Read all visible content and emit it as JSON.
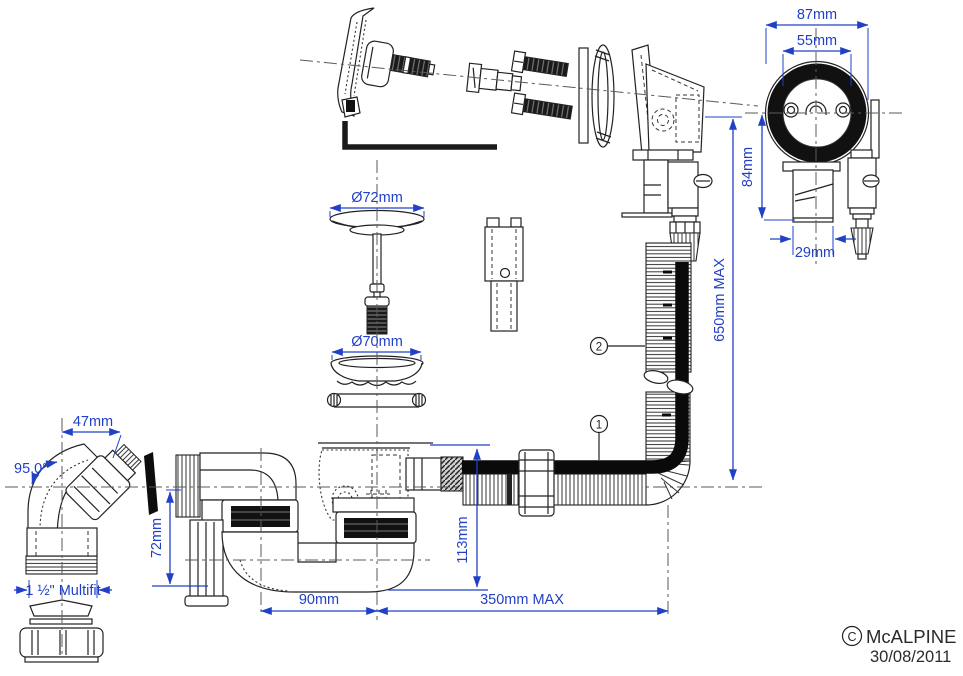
{
  "colors": {
    "dimension": "#2140c8",
    "line": "#222222",
    "dark": "#111111"
  },
  "annotations": {
    "front_width_outer": "87mm",
    "front_width_inner": "55mm",
    "front_height": "84mm",
    "front_outlet_width": "29mm",
    "plug_cap_dia": "Ø72mm",
    "plug_flange_dia": "Ø70mm",
    "elbow_offset": "47mm",
    "elbow_angle": "95.0°",
    "elbow_thread": "1 ½\" Multifit",
    "trap_seal_height": "72mm",
    "trap_outlet_height": "113mm",
    "trap_length": "90mm",
    "trap_extension": "350mm MAX",
    "overflow_hose_height": "650mm MAX"
  },
  "callouts": {
    "item1": "1",
    "item2": "2"
  },
  "title_block": {
    "copyright_symbol": "C",
    "brand": "McALPINE",
    "date": "30/08/2011"
  }
}
